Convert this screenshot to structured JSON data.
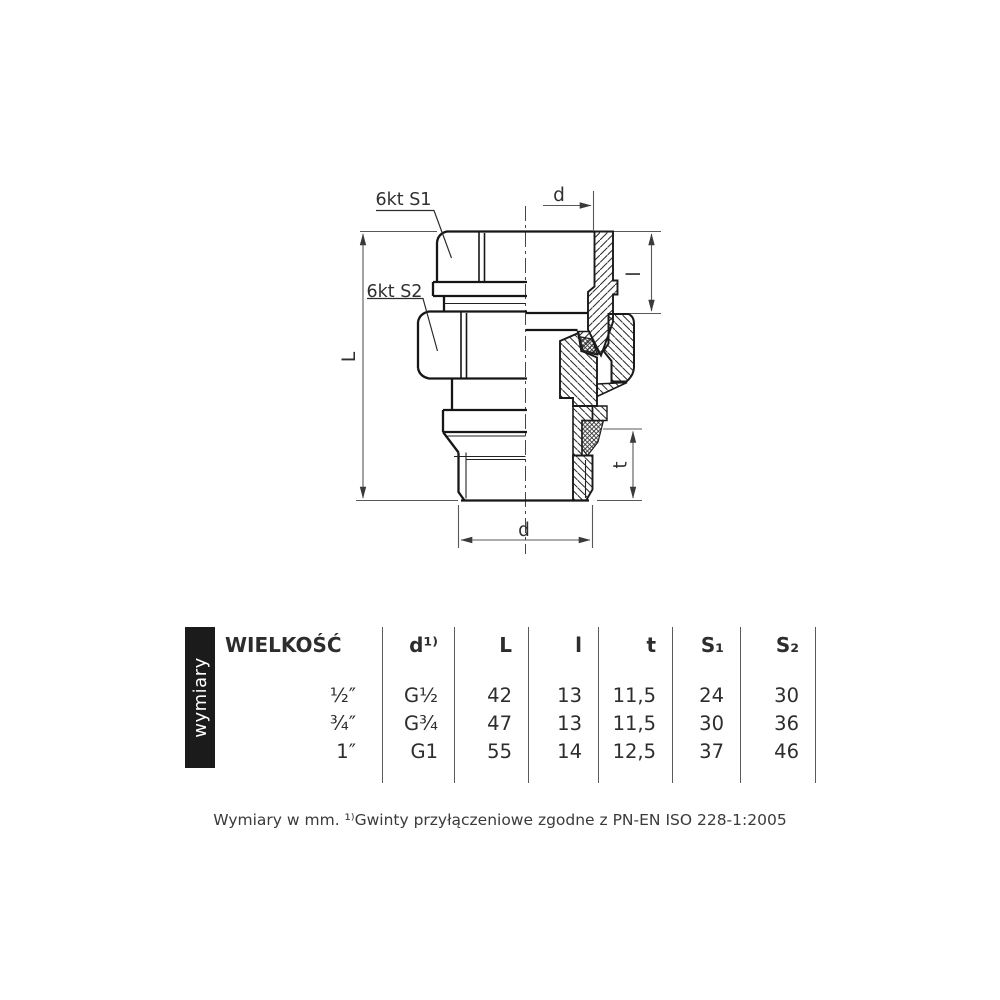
{
  "drawing": {
    "callout_s1": "6kt S1",
    "callout_s2": "6kt S2",
    "dim_d_top": "d",
    "dim_l": "l",
    "dim_length": "L",
    "dim_t": "t",
    "dim_d_bottom": "d"
  },
  "sidebar": {
    "label": "wymiary"
  },
  "table": {
    "headers": [
      "WIELKOŚĆ",
      "d¹⁾",
      "L",
      "l",
      "t",
      "S₁",
      "S₂"
    ],
    "rows": [
      [
        "½″",
        "G½",
        "42",
        "13",
        "11,5",
        "24",
        "30"
      ],
      [
        "¾″",
        "G¾",
        "47",
        "13",
        "11,5",
        "30",
        "36"
      ],
      [
        "1″",
        "G1",
        "55",
        "14",
        "12,5",
        "37",
        "46"
      ]
    ]
  },
  "footnote": "Wymiary w mm. ¹⁾Gwinty przyłączeniowe zgodne z PN-EN ISO 228-1:2005",
  "colors": {
    "background": "#ffffff",
    "outline": "#161616",
    "dimension_line": "#585858",
    "text": "#2e2e2e",
    "sidebar_bg": "#1b1b1b",
    "sidebar_text": "#ffffff"
  }
}
